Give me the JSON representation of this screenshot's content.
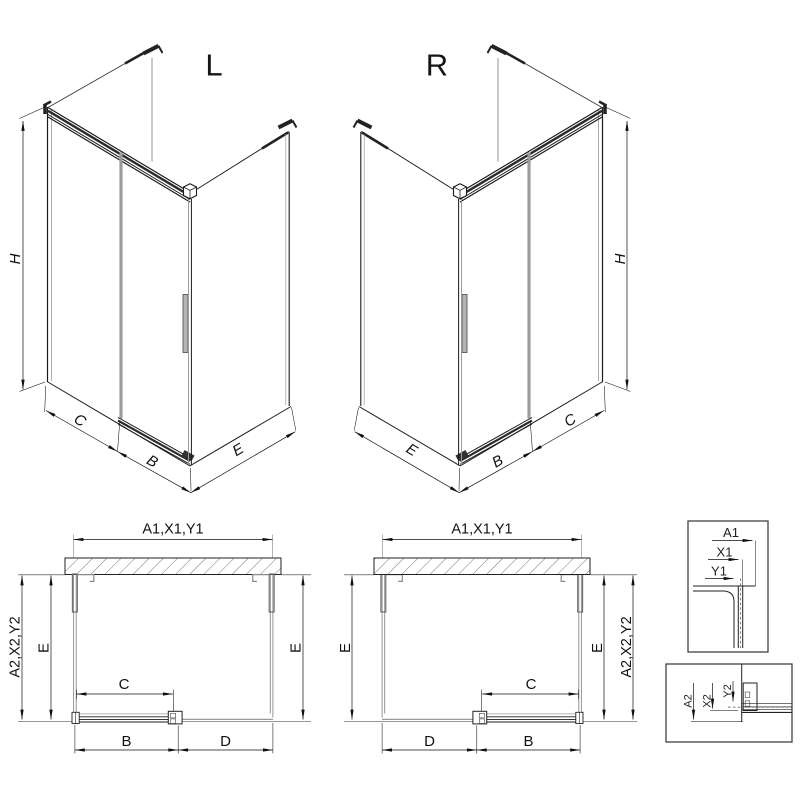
{
  "iso_views": {
    "left": {
      "label": "L"
    },
    "right": {
      "label": "R"
    }
  },
  "dimension_labels": {
    "height": "H",
    "width_fixed": "C",
    "width_door": "B",
    "width_side": "E"
  },
  "plan_views": {
    "top_dimension": "A1,X1,Y1",
    "side_dimension": "A2,X2,Y2",
    "depth": "E",
    "door_travel": "C",
    "door_width": "B",
    "opening_width": "D"
  },
  "detail_views": {
    "top": {
      "dim1": "A1",
      "dim2": "X1",
      "dim3": "Y1"
    },
    "bottom": {
      "dim1": "A2",
      "dim2": "X2",
      "dim3": "Y2"
    }
  },
  "colors": {
    "line": "#1c1c1c",
    "dimension": "#111111",
    "glass_gray": "#9c9c9c",
    "background": "#ffffff"
  }
}
